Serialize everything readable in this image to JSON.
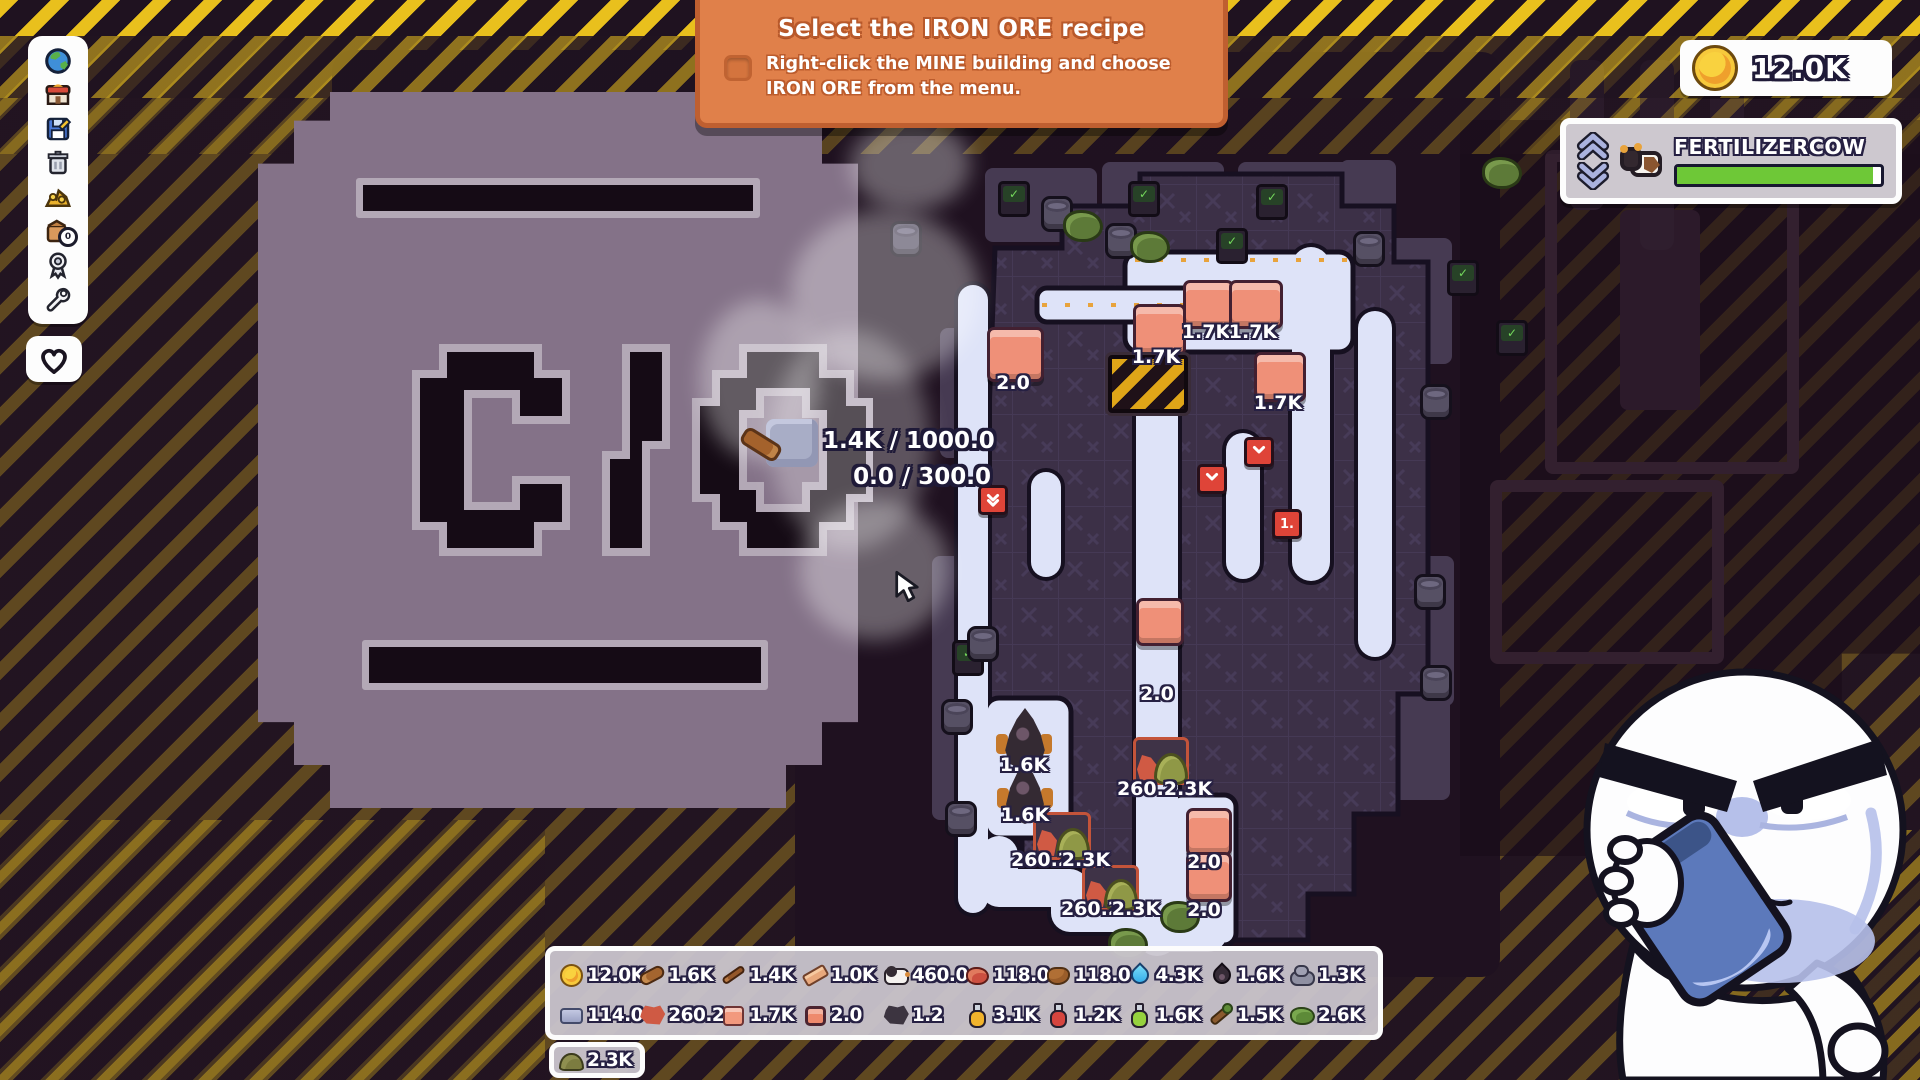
{
  "banner": {
    "title": "Select the IRON ORE recipe",
    "checkbox_checked": false,
    "line1": "Right-click the MINE building and choose",
    "line2": "IRON ORE from the menu."
  },
  "hud": {
    "coins": "12.0K",
    "creature": {
      "name": "FERTILIZERCOW",
      "progress": 0.96
    }
  },
  "toolbar": {
    "inventory_badge": "0",
    "items": [
      "world",
      "shop",
      "save",
      "trash",
      "treasure",
      "inventory",
      "achievements",
      "tools"
    ],
    "heart": "favorite"
  },
  "tooltip": {
    "line1": "1.4K / 1000.0",
    "line2": "0.0 / 300.0"
  },
  "background_emblem": "C O",
  "map": {
    "items": [
      {
        "t": "copper_block",
        "x": 987,
        "y": 327,
        "w": 51,
        "h": 49
      },
      {
        "t": "copper_block",
        "x": 1133,
        "y": 304,
        "w": 47,
        "h": 46
      },
      {
        "t": "copper_block",
        "x": 1183,
        "y": 280,
        "w": 45,
        "h": 43
      },
      {
        "t": "copper_block",
        "x": 1229,
        "y": 280,
        "w": 48,
        "h": 43
      },
      {
        "t": "copper_block",
        "x": 1254,
        "y": 352,
        "w": 46,
        "h": 44
      },
      {
        "t": "copper_block",
        "x": 1136,
        "y": 598,
        "w": 42,
        "h": 42
      },
      {
        "t": "copper_block",
        "x": 1186,
        "y": 808,
        "w": 40,
        "h": 42
      },
      {
        "t": "copper_block",
        "x": 1186,
        "y": 852,
        "w": 40,
        "h": 44
      },
      {
        "t": "oil_drop",
        "x": 1002,
        "y": 708,
        "w": 46,
        "h": 62
      },
      {
        "t": "oil_drop",
        "x": 1003,
        "y": 762,
        "w": 44,
        "h": 62
      },
      {
        "t": "ore_station",
        "x": 1133,
        "y": 737,
        "w": 50,
        "h": 42
      },
      {
        "t": "ore_station",
        "x": 1033,
        "y": 812,
        "w": 52,
        "h": 42
      },
      {
        "t": "ore_station",
        "x": 1082,
        "y": 865,
        "w": 51,
        "h": 40
      },
      {
        "t": "mine",
        "x": 1108,
        "y": 355,
        "w": 72,
        "h": 50
      }
    ],
    "labels": [
      {
        "text": "2.0",
        "x": 1013,
        "y": 383
      },
      {
        "text": "1.7K",
        "x": 1156,
        "y": 357
      },
      {
        "text": "1.7K",
        "x": 1206,
        "y": 332
      },
      {
        "text": "1.7K",
        "x": 1253,
        "y": 332
      },
      {
        "text": "1.7K",
        "x": 1278,
        "y": 403
      },
      {
        "text": "2.0",
        "x": 1157,
        "y": 694
      },
      {
        "text": "1.6K",
        "x": 1024,
        "y": 765
      },
      {
        "text": "1.6K",
        "x": 1025,
        "y": 815
      },
      {
        "text": "260.2",
        "x": 1147,
        "y": 789
      },
      {
        "text": "2.3K",
        "x": 1188,
        "y": 789
      },
      {
        "text": "260.2",
        "x": 1041,
        "y": 860
      },
      {
        "text": "2.3K",
        "x": 1086,
        "y": 860
      },
      {
        "text": "260.2",
        "x": 1091,
        "y": 909
      },
      {
        "text": "2.3K",
        "x": 1136,
        "y": 909
      },
      {
        "text": "2.0",
        "x": 1204,
        "y": 862
      },
      {
        "text": "2.0",
        "x": 1204,
        "y": 910
      }
    ],
    "markers": [
      {
        "type": "down-double",
        "x": 990,
        "y": 497
      },
      {
        "type": "down",
        "x": 1209,
        "y": 476
      },
      {
        "type": "down",
        "x": 1256,
        "y": 449
      },
      {
        "type": "number",
        "text": "1.",
        "x": 1284,
        "y": 521
      }
    ],
    "decorations": [
      {
        "type": "monitor",
        "x": 998,
        "y": 181
      },
      {
        "type": "monitor",
        "x": 1128,
        "y": 181
      },
      {
        "type": "monitor",
        "x": 1256,
        "y": 184
      },
      {
        "type": "monitor",
        "x": 1216,
        "y": 228
      },
      {
        "type": "monitor",
        "x": 1447,
        "y": 260
      },
      {
        "type": "monitor",
        "x": 1496,
        "y": 320
      },
      {
        "type": "monitor",
        "x": 952,
        "y": 640
      },
      {
        "type": "barrel",
        "x": 890,
        "y": 221
      },
      {
        "type": "barrel",
        "x": 1041,
        "y": 196
      },
      {
        "type": "barrel",
        "x": 1105,
        "y": 223
      },
      {
        "type": "barrel",
        "x": 967,
        "y": 626
      },
      {
        "type": "barrel",
        "x": 941,
        "y": 699
      },
      {
        "type": "barrel",
        "x": 945,
        "y": 801
      },
      {
        "type": "barrel",
        "x": 1353,
        "y": 231
      },
      {
        "type": "barrel",
        "x": 1420,
        "y": 384
      },
      {
        "type": "barrel",
        "x": 1414,
        "y": 574
      },
      {
        "type": "barrel",
        "x": 1420,
        "y": 665
      },
      {
        "type": "bush",
        "x": 1063,
        "y": 210
      },
      {
        "type": "bush",
        "x": 1130,
        "y": 231
      },
      {
        "type": "bush",
        "x": 1160,
        "y": 901
      },
      {
        "type": "bush",
        "x": 1108,
        "y": 928
      },
      {
        "type": "bush",
        "x": 1482,
        "y": 157
      }
    ]
  },
  "resources": {
    "rows": [
      [
        {
          "type": "coin",
          "value": "12.0K"
        },
        {
          "type": "log",
          "value": "1.6K"
        },
        {
          "type": "stick",
          "value": "1.4K"
        },
        {
          "type": "plank",
          "value": "1.0K"
        },
        {
          "type": "cow",
          "value": "460.0"
        },
        {
          "type": "meat",
          "value": "118.0"
        },
        {
          "type": "leather",
          "value": "118.0"
        },
        {
          "type": "water",
          "value": "4.3K"
        },
        {
          "type": "oil",
          "value": "1.6K"
        },
        {
          "type": "stone",
          "value": "1.3K"
        }
      ],
      [
        {
          "type": "iron_ingot",
          "value": "114.0"
        },
        {
          "type": "copper_ore",
          "value": "260.2"
        },
        {
          "type": "copper_plate",
          "value": "1.7K"
        },
        {
          "type": "copper_block",
          "value": "2.0"
        },
        {
          "type": "coal",
          "value": "1.2"
        },
        {
          "type": "potion_yellow",
          "value": "3.1K"
        },
        {
          "type": "potion_red",
          "value": "1.2K"
        },
        {
          "type": "potion_green",
          "value": "1.6K"
        },
        {
          "type": "sapling",
          "value": "1.5K"
        },
        {
          "type": "leaves",
          "value": "2.6K"
        }
      ],
      [
        {
          "type": "fertilizer",
          "value": "2.3K"
        }
      ]
    ]
  },
  "colors": {
    "banner_orange": "#e0804a",
    "coin_gold": "#f2b43a",
    "progress_green": "#6ec837",
    "marker_red": "#df4438",
    "copper": "#ef9078",
    "conveyor": "#dee3f8",
    "floor_tile": "#3c3047",
    "hazard_yellow": "#e9c01d"
  }
}
